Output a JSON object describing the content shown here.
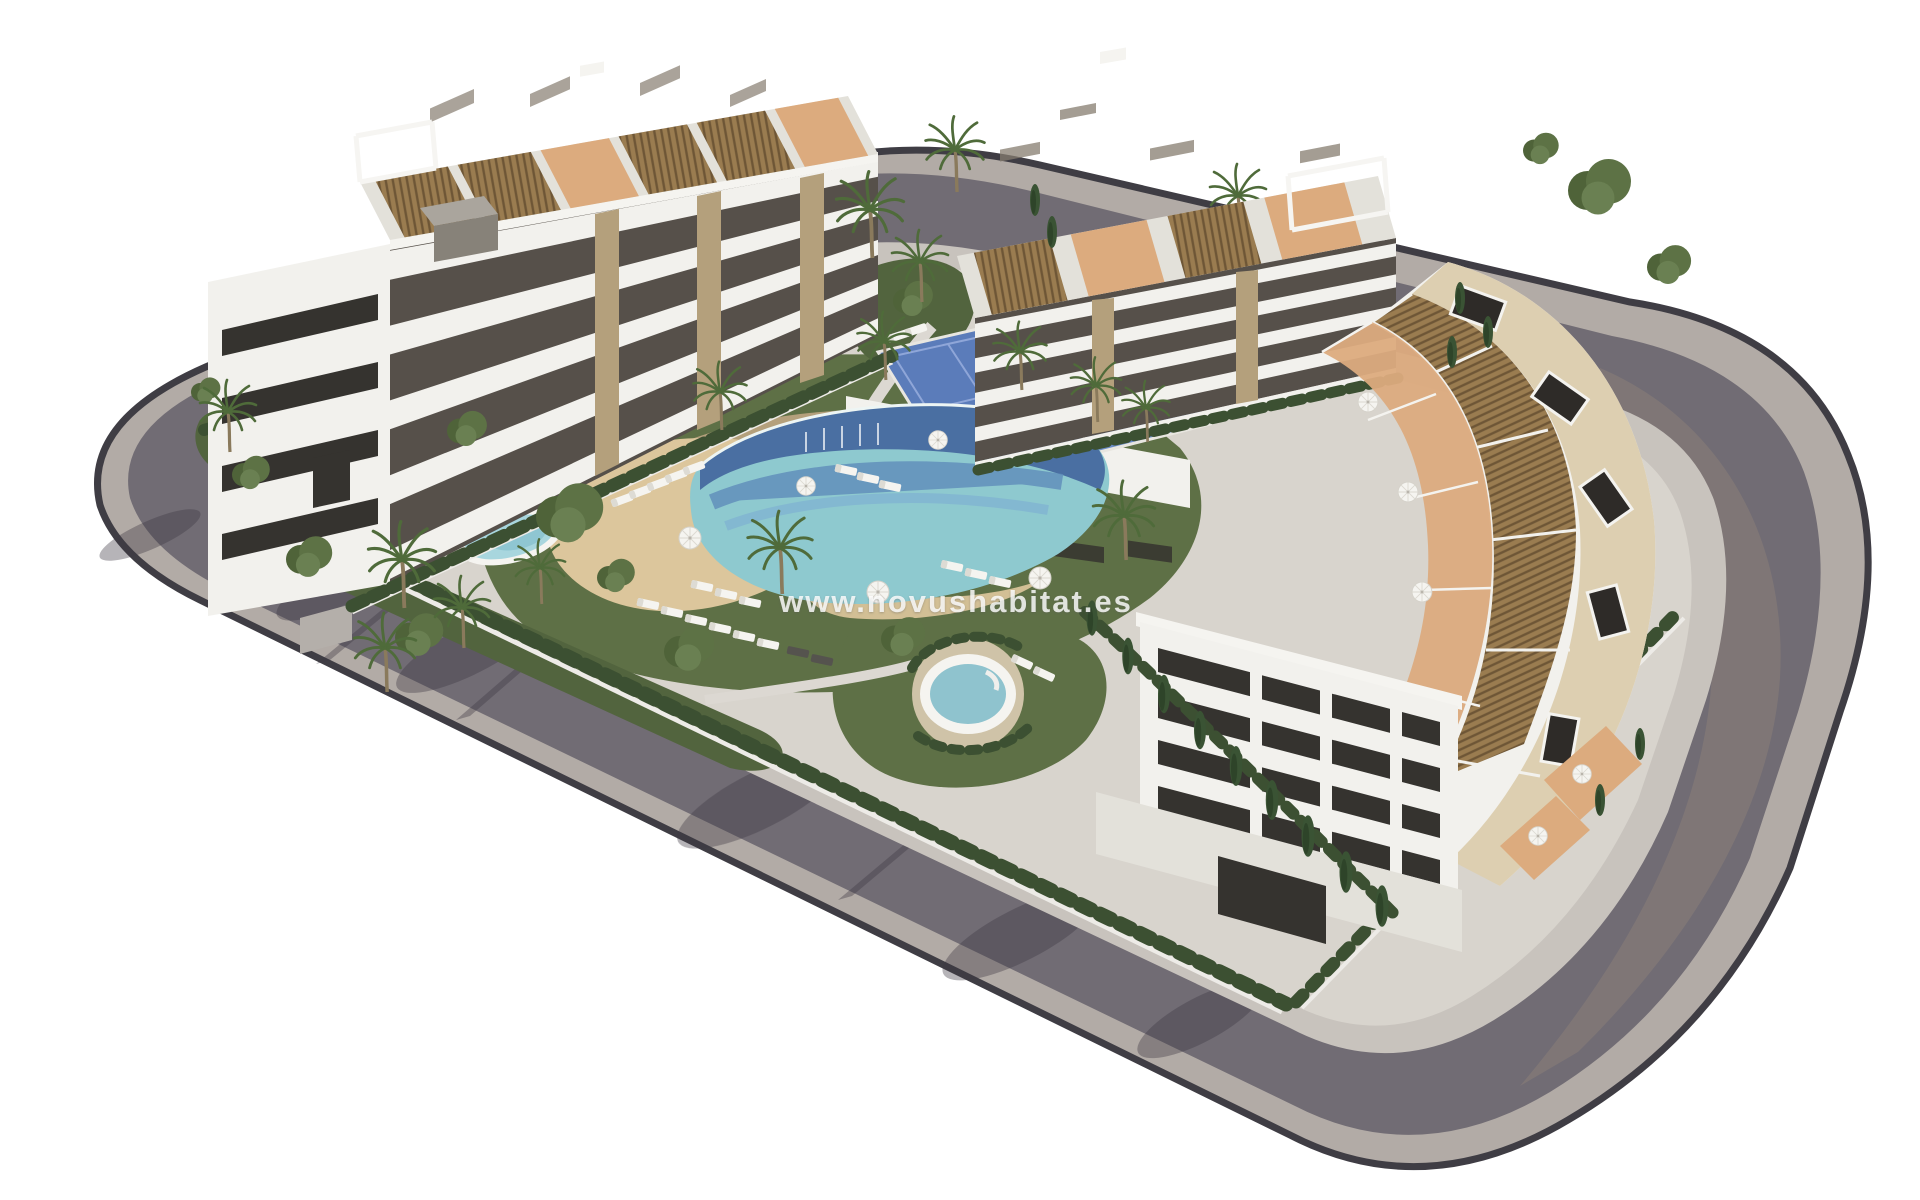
{
  "watermark": {
    "text": "www.novushabitat.es"
  },
  "colors": {
    "background": "#ffffff",
    "sidewalk_outer": "#b2aba6",
    "road_asphalt": "#716c74",
    "road_edge": "#3f3d44",
    "sidewalk_inner": "#c8c3bd",
    "parcel_ground": "#d8d4cd",
    "lawn": "#5e7046",
    "lawn_dark": "#52643e",
    "hedge": "#3c5032",
    "white_wall": "#edebe7",
    "fence": "#2c2b29",
    "building_white": "#f2f1ed",
    "building_shade": "#e3e1da",
    "facade_recess": "#56504a",
    "window_dark": "#35332f",
    "window_glint": "#867d6f",
    "stone_pillar": "#b4a07c",
    "pergola_wood": "#9a7c50",
    "pergola_wood_dark": "#6e5636",
    "terrace_floor": "#dcab7e",
    "roof_deck": "#ddcfb1",
    "sand": "#dcc69c",
    "pool_light": "#8ec9cf",
    "pool_mid": "#5f8cba",
    "pool_dark": "#42659c",
    "pool_edge": "#edf5f4",
    "court_blue": "#5b7cba",
    "court_blue2": "#6a8cc9",
    "jacuzzi": "#8fc3ce",
    "white_furniture": "#f5f4f0",
    "dark_furniture": "#55534e",
    "rooftop_box": "#2e2b28",
    "cast_shadow": "#3f3a44",
    "tree_dark": "#4f6339",
    "tree_mid": "#5d7245",
    "tree_light": "#6a8052",
    "cypress": "#3a5334",
    "trunk": "#8a7a5c",
    "palm_frond": "#4f6b3a",
    "watermark": "#ffffff"
  }
}
